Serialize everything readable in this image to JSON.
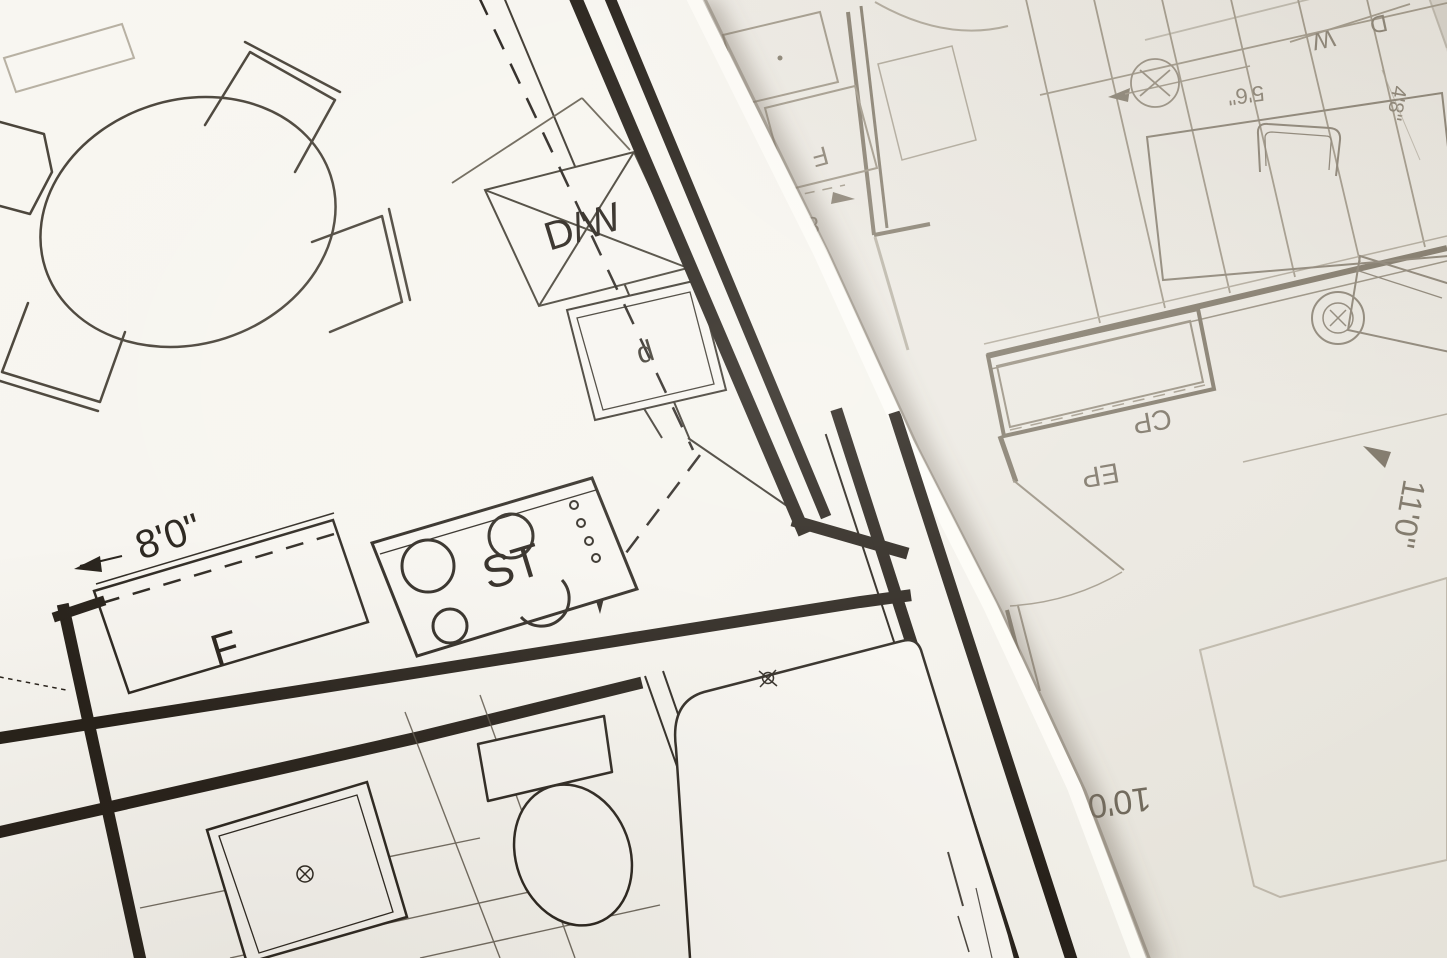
{
  "meta": {
    "scene": "photograph of two overlapping architectural floor-plan blueprints",
    "sheets": 2,
    "orientation_note": "top sheet tilted counter-clockwise; bottom sheet lies upside-down"
  },
  "palette": {
    "paper_top_sheet": "#f7f5f0",
    "paper_bottom_sheet": "#edeae3",
    "ink_dark": "#262019",
    "ink_medium": "#454035",
    "ink_faint": "#9a9284",
    "ink_faint_text": "#7d7567",
    "edge_shadow": "#6e6354",
    "edge_highlight": "#fffef9"
  },
  "left_sheet": {
    "labels": {
      "dishwasher": "D/W",
      "cabinet": "d",
      "stove": "ST",
      "fridge": "F",
      "dim_8ft": "8'0\""
    }
  },
  "right_sheet": {
    "labels": {
      "washer": "W",
      "dryer": "D",
      "closet": "CP",
      "panel": "EP",
      "fridge": "F",
      "dim_8ft": "8'0\"",
      "dim_small_left": "5'6\"",
      "dim_small_right": "4'8\"",
      "dim_11ft": "11'0\"",
      "dim_10ft": "10'0\""
    }
  }
}
